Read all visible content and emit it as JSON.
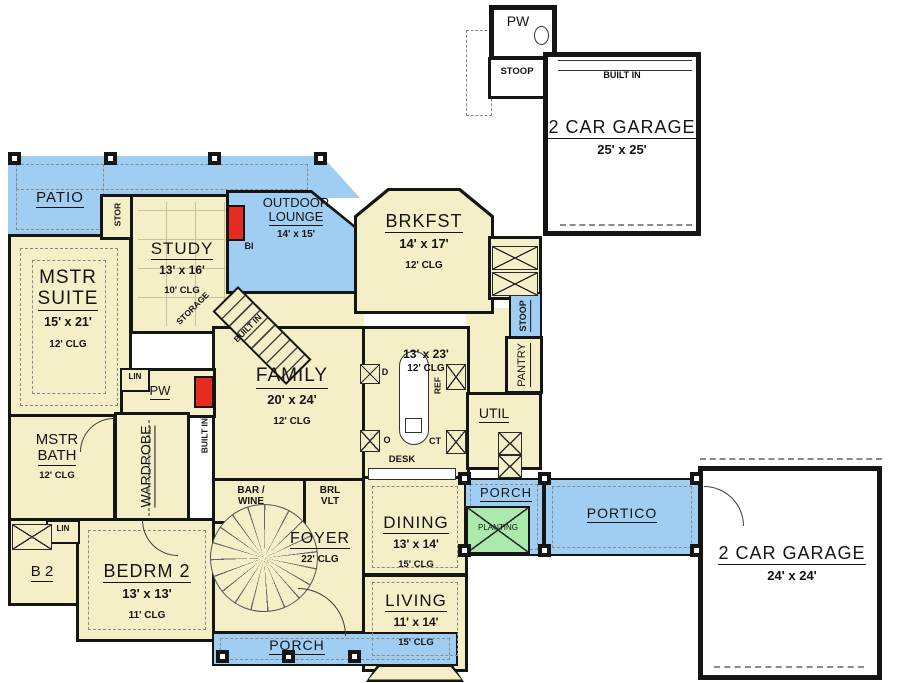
{
  "colors": {
    "cream": "#F5EFC8",
    "blue": "#9FCEF2",
    "green": "#ACE9AC",
    "red": "#E82B20",
    "wall": "#151515"
  },
  "labels": {
    "patio": "PATIO",
    "outdoor_lounge_1": "OUTDOOR",
    "outdoor_lounge_2": "LOUNGE",
    "outdoor_lounge_dim": "14' x 15'",
    "study": "STUDY",
    "study_dim": "13' x 16'",
    "study_clg": "10' CLG",
    "brkfst": "BRKFST",
    "brkfst_dim": "14' x 17'",
    "brkfst_clg": "12' CLG",
    "mstr_suite_1": "MSTR",
    "mstr_suite_2": "SUITE",
    "mstr_suite_dim": "15' x 21'",
    "mstr_suite_clg": "12' CLG",
    "family": "FAMILY",
    "family_dim": "20' x 24'",
    "family_clg": "12' CLG",
    "kitchen_dim": "13' x 23'",
    "kitchen_clg": "12' CLG",
    "mstr_bath_1": "MSTR",
    "mstr_bath_2": "BATH",
    "mstr_bath_clg": "12' CLG",
    "wardrobe": "WARDROBE",
    "bedrm2": "BEDRM 2",
    "bedrm2_dim": "13' x 13'",
    "bedrm2_clg": "11' CLG",
    "b2": "B 2",
    "foyer": "FOYER",
    "foyer_clg": "22' CLG",
    "dining": "DINING",
    "dining_dim": "13' x 14'",
    "dining_clg": "15' CLG",
    "living": "LIVING",
    "living_dim": "11' x 14'",
    "living_clg": "15' CLG",
    "porch_bottom": "PORCH",
    "porch_right": "PORCH",
    "portico": "PORTICO",
    "planting": "PLANTING",
    "garage_top": "2 CAR GARAGE",
    "garage_top_dim": "25' x 25'",
    "garage_right": "2 CAR GARAGE",
    "garage_right_dim": "24' x 24'",
    "built_in_garage": "BUILT IN",
    "pw_top": "PW",
    "stoop_top": "STOOP",
    "stoop_right": "STOOP",
    "pantry": "PANTRY",
    "util": "UTIL",
    "pw_inner": "PW",
    "lin_1": "LIN",
    "lin_2": "LIN",
    "stor": "STOR",
    "storage_diag": "STORAGE",
    "built_in_diag": "BUILT IN",
    "built_in_vert": "BUILT IN",
    "bi": "BI",
    "d": "D",
    "o": "O",
    "ref": "REF",
    "ct": "CT",
    "desk": "DESK",
    "bar_wine_1": "BAR /",
    "bar_wine_2": "WINE",
    "brl_1": "BRL",
    "brl_2": "VLT"
  }
}
